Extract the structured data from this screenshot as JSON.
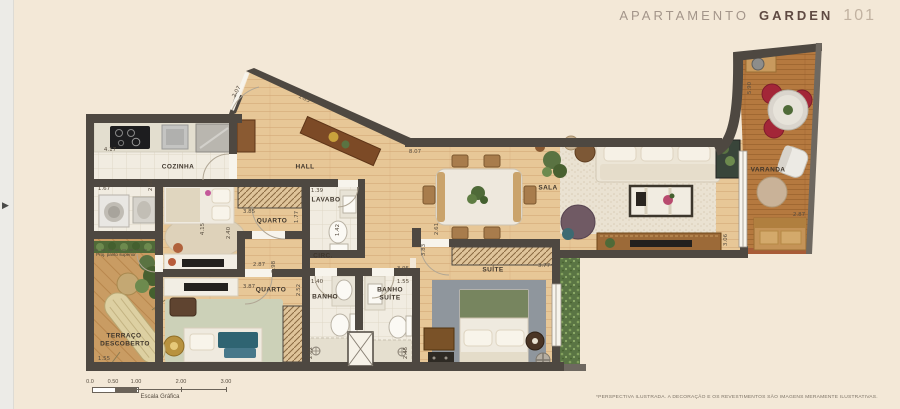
{
  "header": {
    "title_apartamento": "APARTAMENTO",
    "title_garden": "GARDEN",
    "title_number": "101"
  },
  "carousel": {
    "next_arrow": "▶"
  },
  "rooms": {
    "cozinha": "COZINHA",
    "hall": "HALL",
    "lavabo": "LAVABO",
    "quarto1": "QUARTO",
    "circ": "CIRC.",
    "quarto2": "QUARTO",
    "banho": "BANHO",
    "banho_suite_l1": "BANHO",
    "banho_suite_l2": "SUÍTE",
    "suite": "SUÍTE",
    "sala": "SALA",
    "varanda": "VARANDA",
    "terraco_l1": "TERRAÇO",
    "terraco_l2": "DESCOBERTO",
    "proj_note": "Proj. pavto superior"
  },
  "dims": [
    "4.17",
    "1.67",
    "2.68",
    "3.85",
    "1.77",
    "1.39",
    "1.42",
    "1.83",
    "2.07",
    "8.07",
    "2.87",
    "0.98",
    "3.87",
    "2.52",
    "1.40",
    "2.62",
    "1.55",
    "3.95",
    "2.45",
    "3.77",
    "3.83",
    "2.61",
    "3.06",
    "5.90",
    "2.87",
    "1.55",
    "4.15",
    "2.40"
  ],
  "scale_bar": {
    "ticks": [
      "0.0",
      "0.50",
      "1.00",
      "2.00",
      "3.00"
    ],
    "caption": "Escala Gráfica"
  },
  "footer": {
    "disclaimer": "*PERSPECTIVA ILUSTRADA. A DECORAÇÃO E OS REVESTIMENTOS SÃO IMAGENS MERAMENTE ILUSTRATIVAS."
  },
  "colors": {
    "background": "#f3e8d7",
    "wall": "#4e4841",
    "wood_light": "#e7c797",
    "wood_deck": "#b5793f",
    "accent_red": "#a32638",
    "hedge_green": "#5a7544"
  }
}
